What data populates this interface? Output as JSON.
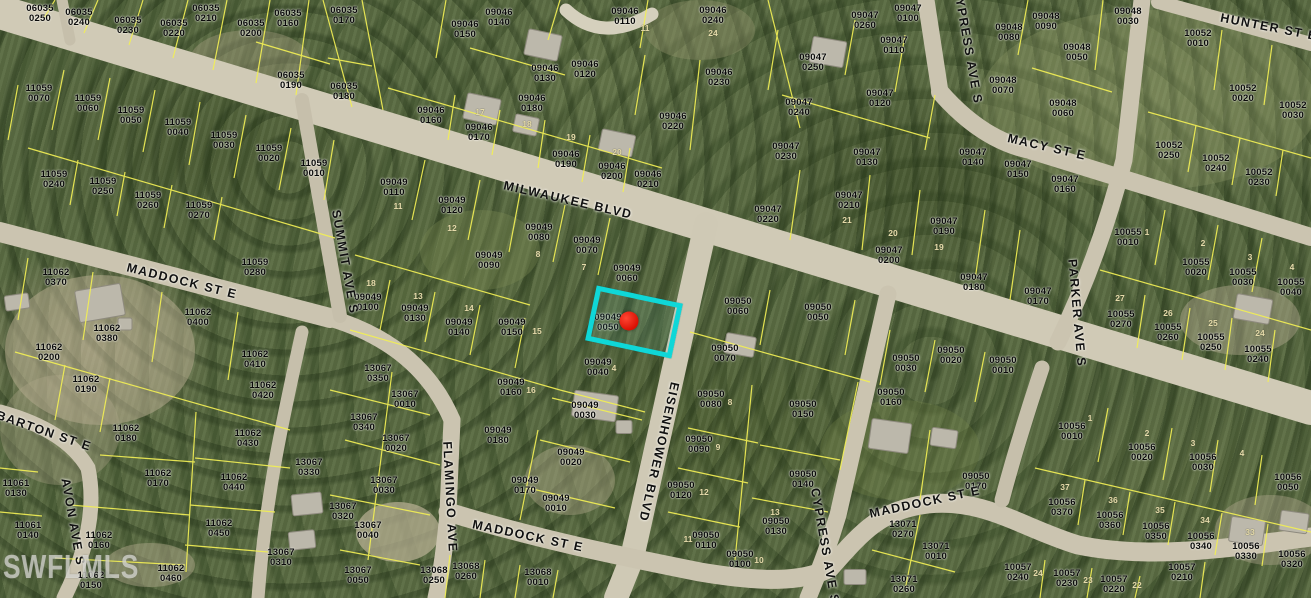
{
  "map": {
    "watermark": "SWFLMLS",
    "colors": {
      "highlight": "#0fd7d7",
      "marker": "#d90f02",
      "parcel_line": "#f2ef55",
      "road": "#cbc4b0",
      "parcel_label": "#0a0a0a",
      "lot_number": "#e6dcab"
    },
    "selected_parcel": {
      "id": "09049 0050",
      "x": 634,
      "y": 322,
      "width": 78,
      "height": 46,
      "rotation": 12,
      "marker_x": 629,
      "marker_y": 321
    },
    "streets": [
      {
        "name": "MILWAUKEE BLVD",
        "x": 568,
        "y": 200,
        "rotation": 13
      },
      {
        "name": "MADDOCK ST E",
        "x": 182,
        "y": 281,
        "rotation": 14
      },
      {
        "name": "MADDOCK ST E",
        "x": 528,
        "y": 536,
        "rotation": 12
      },
      {
        "name": "MADDOCK ST E",
        "x": 925,
        "y": 502,
        "rotation": -12
      },
      {
        "name": "EISENHOWER BLVD",
        "x": 659,
        "y": 452,
        "rotation": 103
      },
      {
        "name": "SUMMIT AVE S",
        "x": 345,
        "y": 262,
        "rotation": 80
      },
      {
        "name": "FLAMINGO AVE",
        "x": 450,
        "y": 497,
        "rotation": 87
      },
      {
        "name": "CYPRESS AVE S",
        "x": 968,
        "y": 46,
        "rotation": 80
      },
      {
        "name": "CYPRESS AVE S",
        "x": 825,
        "y": 546,
        "rotation": 80
      },
      {
        "name": "PARKER AVE S",
        "x": 1077,
        "y": 313,
        "rotation": 85
      },
      {
        "name": "MACY ST E",
        "x": 1047,
        "y": 147,
        "rotation": 13
      },
      {
        "name": "HUNTER ST E",
        "x": 1269,
        "y": 27,
        "rotation": 11
      },
      {
        "name": "BARTON ST E",
        "x": 44,
        "y": 431,
        "rotation": 19
      },
      {
        "name": "AVON AVE S",
        "x": 73,
        "y": 522,
        "rotation": 80
      }
    ],
    "parcel_labels": [
      {
        "id": "06035 0250",
        "x": 40,
        "y": 14
      },
      {
        "id": "06035 0240",
        "x": 79,
        "y": 18
      },
      {
        "id": "06035 0230",
        "x": 128,
        "y": 26
      },
      {
        "id": "06035 0220",
        "x": 174,
        "y": 29
      },
      {
        "id": "06035 0210",
        "x": 206,
        "y": 14
      },
      {
        "id": "06035 0200",
        "x": 251,
        "y": 29
      },
      {
        "id": "06035 0160",
        "x": 288,
        "y": 19
      },
      {
        "id": "06035 0190",
        "x": 291,
        "y": 81
      },
      {
        "id": "06035 0170",
        "x": 344,
        "y": 16
      },
      {
        "id": "06035 0180",
        "x": 344,
        "y": 92
      },
      {
        "id": "09046 0150",
        "x": 465,
        "y": 30
      },
      {
        "id": "09046 0140",
        "x": 499,
        "y": 18
      },
      {
        "id": "09046 0110",
        "x": 625,
        "y": 17
      },
      {
        "id": "09046 0130",
        "x": 545,
        "y": 74
      },
      {
        "id": "09046 0120",
        "x": 585,
        "y": 70
      },
      {
        "id": "09046 0160",
        "x": 431,
        "y": 116
      },
      {
        "id": "09046 0170",
        "x": 479,
        "y": 133
      },
      {
        "id": "09046 0180",
        "x": 532,
        "y": 104
      },
      {
        "id": "09046 0190",
        "x": 566,
        "y": 160
      },
      {
        "id": "09046 0200",
        "x": 612,
        "y": 172
      },
      {
        "id": "09046 0210",
        "x": 648,
        "y": 180
      },
      {
        "id": "09046 0240",
        "x": 713,
        "y": 16
      },
      {
        "id": "09046 0230",
        "x": 719,
        "y": 78
      },
      {
        "id": "09046 0220",
        "x": 673,
        "y": 122
      },
      {
        "id": "09047 0260",
        "x": 865,
        "y": 21
      },
      {
        "id": "09047 0100",
        "x": 908,
        "y": 14
      },
      {
        "id": "09047 0110",
        "x": 894,
        "y": 46
      },
      {
        "id": "09047 0250",
        "x": 813,
        "y": 63
      },
      {
        "id": "09047 0240",
        "x": 799,
        "y": 108
      },
      {
        "id": "09047 0120",
        "x": 880,
        "y": 99
      },
      {
        "id": "09047 0230",
        "x": 786,
        "y": 152
      },
      {
        "id": "09047 0130",
        "x": 867,
        "y": 158
      },
      {
        "id": "09047 0140",
        "x": 973,
        "y": 158
      },
      {
        "id": "09047 0150",
        "x": 1018,
        "y": 170
      },
      {
        "id": "09047 0160",
        "x": 1065,
        "y": 185
      },
      {
        "id": "09047 0220",
        "x": 768,
        "y": 215
      },
      {
        "id": "09047 0210",
        "x": 849,
        "y": 201
      },
      {
        "id": "09047 0200",
        "x": 889,
        "y": 256
      },
      {
        "id": "09047 0190",
        "x": 944,
        "y": 227
      },
      {
        "id": "09047 0180",
        "x": 974,
        "y": 283
      },
      {
        "id": "09047 0170",
        "x": 1038,
        "y": 297
      },
      {
        "id": "09048 0090",
        "x": 1046,
        "y": 22
      },
      {
        "id": "09048 0080",
        "x": 1009,
        "y": 33
      },
      {
        "id": "09048 0030",
        "x": 1128,
        "y": 17
      },
      {
        "id": "09048 0050",
        "x": 1077,
        "y": 53
      },
      {
        "id": "09048 0060",
        "x": 1063,
        "y": 109
      },
      {
        "id": "09048 0070",
        "x": 1003,
        "y": 86
      },
      {
        "id": "10052 0010",
        "x": 1198,
        "y": 39
      },
      {
        "id": "10052 0020",
        "x": 1243,
        "y": 94
      },
      {
        "id": "10052 0030",
        "x": 1293,
        "y": 111
      },
      {
        "id": "10052 0250",
        "x": 1169,
        "y": 151
      },
      {
        "id": "10052 0240",
        "x": 1216,
        "y": 164
      },
      {
        "id": "10052 0230",
        "x": 1259,
        "y": 178
      },
      {
        "id": "11059 0070",
        "x": 39,
        "y": 94
      },
      {
        "id": "11059 0060",
        "x": 88,
        "y": 104
      },
      {
        "id": "11059 0050",
        "x": 131,
        "y": 116
      },
      {
        "id": "11059 0040",
        "x": 178,
        "y": 128
      },
      {
        "id": "11059 0030",
        "x": 224,
        "y": 141
      },
      {
        "id": "11059 0020",
        "x": 269,
        "y": 154
      },
      {
        "id": "11059 0010",
        "x": 314,
        "y": 169
      },
      {
        "id": "11059 0240",
        "x": 54,
        "y": 180
      },
      {
        "id": "11059 0250",
        "x": 103,
        "y": 187
      },
      {
        "id": "11059 0260",
        "x": 148,
        "y": 201
      },
      {
        "id": "11059 0270",
        "x": 199,
        "y": 211
      },
      {
        "id": "11059 0280",
        "x": 255,
        "y": 268
      },
      {
        "id": "11062 0370",
        "x": 56,
        "y": 278
      },
      {
        "id": "11062 0380",
        "x": 107,
        "y": 334
      },
      {
        "id": "11062 0400",
        "x": 198,
        "y": 318
      },
      {
        "id": "11062 0410",
        "x": 255,
        "y": 360
      },
      {
        "id": "11062 0200",
        "x": 49,
        "y": 353
      },
      {
        "id": "11062 0190",
        "x": 86,
        "y": 385
      },
      {
        "id": "11062 0420",
        "x": 263,
        "y": 391
      },
      {
        "id": "11062 0180",
        "x": 126,
        "y": 434
      },
      {
        "id": "11062 0430",
        "x": 248,
        "y": 439
      },
      {
        "id": "11062 0170",
        "x": 158,
        "y": 479
      },
      {
        "id": "11062 0440",
        "x": 234,
        "y": 483
      },
      {
        "id": "11062 0160",
        "x": 99,
        "y": 541
      },
      {
        "id": "11062 0450",
        "x": 219,
        "y": 529
      },
      {
        "id": "11062 0460",
        "x": 171,
        "y": 574
      },
      {
        "id": "11062 0150",
        "x": 91,
        "y": 581
      },
      {
        "id": "11061 0130",
        "x": 16,
        "y": 489
      },
      {
        "id": "11061 0140",
        "x": 28,
        "y": 531
      },
      {
        "id": "13067 0350",
        "x": 378,
        "y": 374
      },
      {
        "id": "13067 0010",
        "x": 405,
        "y": 400
      },
      {
        "id": "13067 0340",
        "x": 364,
        "y": 423
      },
      {
        "id": "13067 0020",
        "x": 396,
        "y": 444
      },
      {
        "id": "13067 0030",
        "x": 384,
        "y": 486
      },
      {
        "id": "13067 0320",
        "x": 343,
        "y": 512
      },
      {
        "id": "13067 0040",
        "x": 368,
        "y": 531
      },
      {
        "id": "13067 0050",
        "x": 358,
        "y": 576
      },
      {
        "id": "13067 0330",
        "x": 309,
        "y": 468
      },
      {
        "id": "13067 0310",
        "x": 281,
        "y": 558
      },
      {
        "id": "13068 0250",
        "x": 434,
        "y": 576
      },
      {
        "id": "13068 0260",
        "x": 466,
        "y": 572
      },
      {
        "id": "13068 0010",
        "x": 538,
        "y": 578
      },
      {
        "id": "09049 0110",
        "x": 394,
        "y": 188
      },
      {
        "id": "09049 0120",
        "x": 452,
        "y": 206
      },
      {
        "id": "09049 0080",
        "x": 539,
        "y": 233
      },
      {
        "id": "09049 0070",
        "x": 587,
        "y": 246
      },
      {
        "id": "09049 0060",
        "x": 627,
        "y": 274
      },
      {
        "id": "09049 0090",
        "x": 489,
        "y": 261
      },
      {
        "id": "09049 0100",
        "x": 368,
        "y": 303
      },
      {
        "id": "09049 0130",
        "x": 415,
        "y": 314
      },
      {
        "id": "09049 0140",
        "x": 459,
        "y": 328
      },
      {
        "id": "09049 0150",
        "x": 512,
        "y": 328
      },
      {
        "id": "09049 0050",
        "x": 608,
        "y": 323
      },
      {
        "id": "09049 0040",
        "x": 598,
        "y": 368
      },
      {
        "id": "09049 0160",
        "x": 511,
        "y": 388
      },
      {
        "id": "09049 0030",
        "x": 585,
        "y": 411
      },
      {
        "id": "09049 0020",
        "x": 571,
        "y": 458
      },
      {
        "id": "09049 0010",
        "x": 556,
        "y": 504
      },
      {
        "id": "09049 0180",
        "x": 498,
        "y": 436
      },
      {
        "id": "09049 0170",
        "x": 525,
        "y": 486
      },
      {
        "id": "09050 0060",
        "x": 738,
        "y": 307
      },
      {
        "id": "09050 0050",
        "x": 818,
        "y": 313
      },
      {
        "id": "09050 0070",
        "x": 725,
        "y": 354
      },
      {
        "id": "09050 0020",
        "x": 951,
        "y": 356
      },
      {
        "id": "09050 0030",
        "x": 906,
        "y": 364
      },
      {
        "id": "09050 0010",
        "x": 1003,
        "y": 366
      },
      {
        "id": "09050 0080",
        "x": 711,
        "y": 400
      },
      {
        "id": "09050 0090",
        "x": 699,
        "y": 445
      },
      {
        "id": "09050 0120",
        "x": 681,
        "y": 491
      },
      {
        "id": "09050 0110",
        "x": 706,
        "y": 541
      },
      {
        "id": "09050 0100",
        "x": 740,
        "y": 560
      },
      {
        "id": "09050 0130",
        "x": 776,
        "y": 527
      },
      {
        "id": "09050 0140",
        "x": 803,
        "y": 480
      },
      {
        "id": "09050 0150",
        "x": 803,
        "y": 410
      },
      {
        "id": "09050 0160",
        "x": 891,
        "y": 398
      },
      {
        "id": "09050 0170",
        "x": 976,
        "y": 482
      },
      {
        "id": "13071 0270",
        "x": 903,
        "y": 530
      },
      {
        "id": "13071 0010",
        "x": 936,
        "y": 552
      },
      {
        "id": "13071 0260",
        "x": 904,
        "y": 585
      },
      {
        "id": "10055 0010",
        "x": 1128,
        "y": 238
      },
      {
        "id": "10055 0020",
        "x": 1196,
        "y": 268
      },
      {
        "id": "10055 0030",
        "x": 1243,
        "y": 278
      },
      {
        "id": "10055 0040",
        "x": 1291,
        "y": 288
      },
      {
        "id": "10055 0270",
        "x": 1121,
        "y": 320
      },
      {
        "id": "10055 0260",
        "x": 1168,
        "y": 333
      },
      {
        "id": "10055 0250",
        "x": 1211,
        "y": 343
      },
      {
        "id": "10055 0240",
        "x": 1258,
        "y": 355
      },
      {
        "id": "10056 0010",
        "x": 1072,
        "y": 432
      },
      {
        "id": "10056 0020",
        "x": 1142,
        "y": 453
      },
      {
        "id": "10056 0030",
        "x": 1203,
        "y": 463
      },
      {
        "id": "10056 0050",
        "x": 1288,
        "y": 483
      },
      {
        "id": "10056 0370",
        "x": 1062,
        "y": 508
      },
      {
        "id": "10056 0360",
        "x": 1110,
        "y": 521
      },
      {
        "id": "10056 0350",
        "x": 1156,
        "y": 532
      },
      {
        "id": "10056 0340",
        "x": 1201,
        "y": 542
      },
      {
        "id": "10056 0330",
        "x": 1246,
        "y": 552
      },
      {
        "id": "10056 0320",
        "x": 1292,
        "y": 560
      },
      {
        "id": "10057 0240",
        "x": 1018,
        "y": 573
      },
      {
        "id": "10057 0230",
        "x": 1067,
        "y": 579
      },
      {
        "id": "10057 0220",
        "x": 1114,
        "y": 585
      },
      {
        "id": "10057 0210",
        "x": 1182,
        "y": 573
      }
    ],
    "lot_numbers": [
      {
        "t": "11",
        "x": 398,
        "y": 206
      },
      {
        "t": "12",
        "x": 452,
        "y": 228
      },
      {
        "t": "8",
        "x": 538,
        "y": 254
      },
      {
        "t": "7",
        "x": 584,
        "y": 267
      },
      {
        "t": "18",
        "x": 371,
        "y": 283
      },
      {
        "t": "13",
        "x": 418,
        "y": 296
      },
      {
        "t": "14",
        "x": 469,
        "y": 308
      },
      {
        "t": "15",
        "x": 537,
        "y": 331
      },
      {
        "t": "4",
        "x": 614,
        "y": 368
      },
      {
        "t": "16",
        "x": 531,
        "y": 390
      },
      {
        "t": "11",
        "x": 645,
        "y": 28
      },
      {
        "t": "24",
        "x": 713,
        "y": 33
      },
      {
        "t": "17",
        "x": 480,
        "y": 112
      },
      {
        "t": "18",
        "x": 527,
        "y": 124
      },
      {
        "t": "19",
        "x": 571,
        "y": 137
      },
      {
        "t": "20",
        "x": 617,
        "y": 152
      },
      {
        "t": "21",
        "x": 847,
        "y": 220
      },
      {
        "t": "20",
        "x": 893,
        "y": 233
      },
      {
        "t": "19",
        "x": 939,
        "y": 247
      },
      {
        "t": "8",
        "x": 730,
        "y": 402
      },
      {
        "t": "9",
        "x": 718,
        "y": 447
      },
      {
        "t": "12",
        "x": 704,
        "y": 492
      },
      {
        "t": "11",
        "x": 688,
        "y": 539
      },
      {
        "t": "10",
        "x": 759,
        "y": 560
      },
      {
        "t": "13",
        "x": 775,
        "y": 512
      },
      {
        "t": "1",
        "x": 1147,
        "y": 232
      },
      {
        "t": "2",
        "x": 1203,
        "y": 243
      },
      {
        "t": "3",
        "x": 1250,
        "y": 257
      },
      {
        "t": "4",
        "x": 1292,
        "y": 267
      },
      {
        "t": "27",
        "x": 1120,
        "y": 298
      },
      {
        "t": "26",
        "x": 1168,
        "y": 313
      },
      {
        "t": "25",
        "x": 1213,
        "y": 323
      },
      {
        "t": "24",
        "x": 1260,
        "y": 333
      },
      {
        "t": "1",
        "x": 1090,
        "y": 418
      },
      {
        "t": "2",
        "x": 1147,
        "y": 433
      },
      {
        "t": "3",
        "x": 1193,
        "y": 443
      },
      {
        "t": "4",
        "x": 1242,
        "y": 453
      },
      {
        "t": "37",
        "x": 1065,
        "y": 487
      },
      {
        "t": "36",
        "x": 1113,
        "y": 500
      },
      {
        "t": "35",
        "x": 1160,
        "y": 510
      },
      {
        "t": "34",
        "x": 1205,
        "y": 520
      },
      {
        "t": "33",
        "x": 1250,
        "y": 532
      },
      {
        "t": "24",
        "x": 1038,
        "y": 573
      },
      {
        "t": "23",
        "x": 1088,
        "y": 580
      },
      {
        "t": "22",
        "x": 1137,
        "y": 585
      }
    ],
    "buildings": [
      {
        "x": 100,
        "y": 303,
        "w": 46,
        "h": 32,
        "r": -10
      },
      {
        "x": 125,
        "y": 324,
        "w": 14,
        "h": 12,
        "r": 0
      },
      {
        "x": 17,
        "y": 302,
        "w": 24,
        "h": 15,
        "r": -8
      },
      {
        "x": 543,
        "y": 45,
        "w": 34,
        "h": 26,
        "r": 12
      },
      {
        "x": 482,
        "y": 109,
        "w": 34,
        "h": 26,
        "r": 12
      },
      {
        "x": 526,
        "y": 125,
        "w": 24,
        "h": 18,
        "r": 12
      },
      {
        "x": 617,
        "y": 143,
        "w": 34,
        "h": 22,
        "r": 12
      },
      {
        "x": 828,
        "y": 52,
        "w": 34,
        "h": 26,
        "r": 10
      },
      {
        "x": 595,
        "y": 406,
        "w": 44,
        "h": 26,
        "r": 8
      },
      {
        "x": 624,
        "y": 427,
        "w": 16,
        "h": 13,
        "r": 0
      },
      {
        "x": 890,
        "y": 436,
        "w": 40,
        "h": 30,
        "r": 8
      },
      {
        "x": 944,
        "y": 438,
        "w": 26,
        "h": 18,
        "r": 8
      },
      {
        "x": 1253,
        "y": 309,
        "w": 36,
        "h": 25,
        "r": 10
      },
      {
        "x": 1247,
        "y": 531,
        "w": 34,
        "h": 25,
        "r": 8
      },
      {
        "x": 1294,
        "y": 522,
        "w": 28,
        "h": 20,
        "r": 8
      },
      {
        "x": 307,
        "y": 504,
        "w": 30,
        "h": 21,
        "r": -6
      },
      {
        "x": 302,
        "y": 540,
        "w": 26,
        "h": 18,
        "r": -6
      },
      {
        "x": 855,
        "y": 577,
        "w": 22,
        "h": 15,
        "r": 0
      },
      {
        "x": 740,
        "y": 345,
        "w": 30,
        "h": 20,
        "r": 10
      }
    ]
  }
}
